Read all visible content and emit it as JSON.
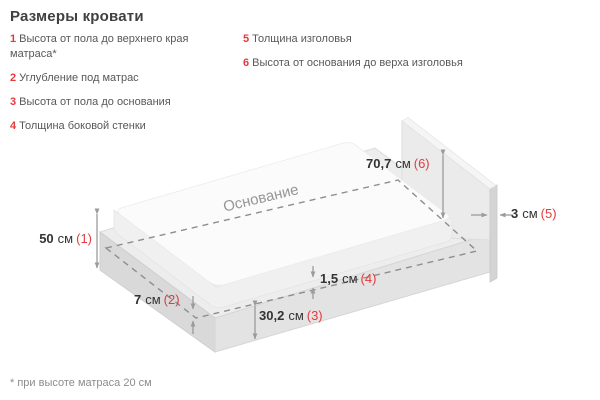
{
  "title": "Размеры кровати",
  "legend": {
    "items_left": [
      {
        "num": "1",
        "label": "Высота от пола до верхнего края матраса*"
      },
      {
        "num": "2",
        "label": "Углубление под матрас"
      },
      {
        "num": "3",
        "label": "Высота от пола до основания"
      },
      {
        "num": "4",
        "label": "Толщина боковой стенки"
      }
    ],
    "items_right": [
      {
        "num": "5",
        "label": "Толщина изголовья"
      },
      {
        "num": "6",
        "label": "Высота от основания до верха изголовья"
      }
    ]
  },
  "diagram": {
    "base_label": "Основание",
    "dimensions": [
      {
        "value": "50",
        "unit": "см",
        "ref": "(1)"
      },
      {
        "value": "7",
        "unit": "см",
        "ref": "(2)"
      },
      {
        "value": "30,2",
        "unit": "см",
        "ref": "(3)"
      },
      {
        "value": "1,5",
        "unit": "см",
        "ref": "(4)"
      },
      {
        "value": "3",
        "unit": "см",
        "ref": "(5)"
      },
      {
        "value": "70,7",
        "unit": "см",
        "ref": "(6)"
      }
    ]
  },
  "footnote": "* при высоте матраса 20 см",
  "colors": {
    "accent_red": "#e23b3e",
    "text_dark": "#3f4042",
    "text_grey": "#57585a",
    "line_grey": "#9b9b9b"
  }
}
